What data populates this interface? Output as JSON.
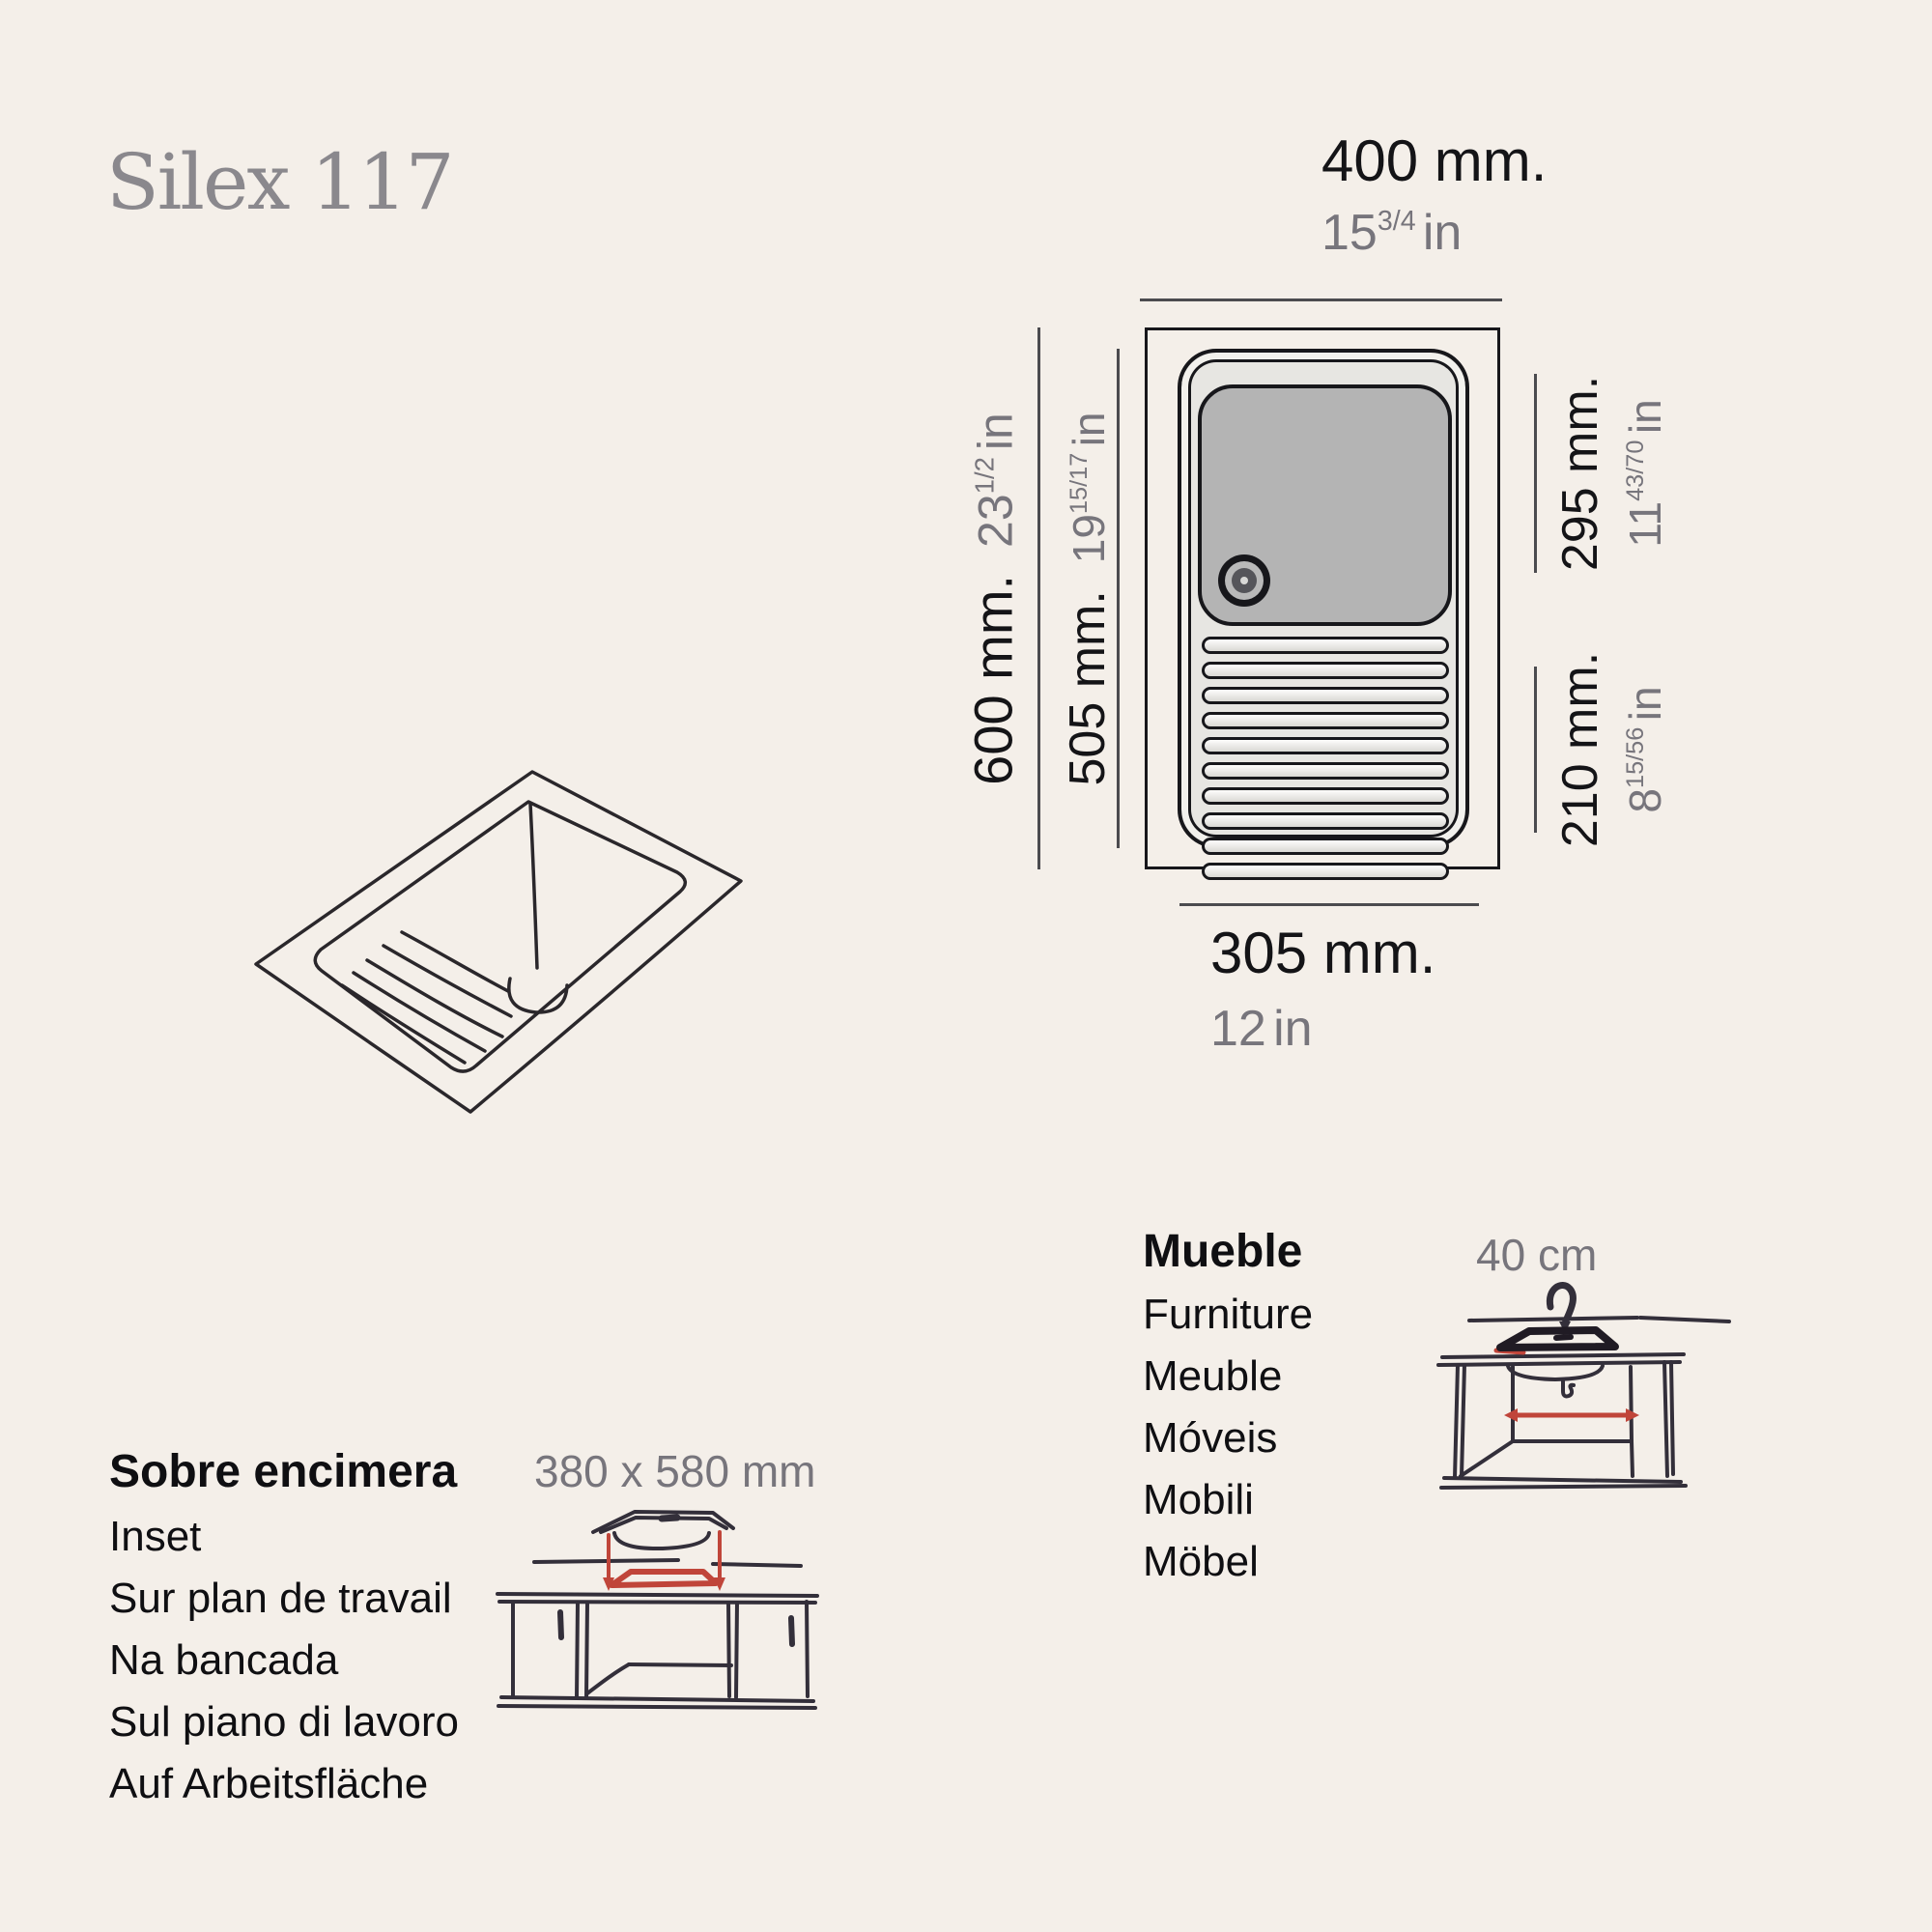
{
  "title": "Silex 117",
  "product_diagram": {
    "dim_top": {
      "mm": "400 mm.",
      "inch_main": "15",
      "inch_frac": "3/4",
      "inch_unit": "in"
    },
    "dim_left_outer": {
      "mm": "600 mm.",
      "inch_main": "23",
      "inch_frac": "1/2",
      "inch_unit": "in"
    },
    "dim_left_inner": {
      "mm": "505 mm.",
      "inch_main": "19",
      "inch_frac": "15/17",
      "inch_unit": "in"
    },
    "dim_right_upper": {
      "mm": "295 mm.",
      "inch_main": "11",
      "inch_frac": "43/70",
      "inch_unit": "in"
    },
    "dim_right_lower": {
      "mm": "210 mm.",
      "inch_main": "8",
      "inch_frac": "15/56",
      "inch_unit": "in"
    },
    "dim_bottom": {
      "mm": "305 mm.",
      "inch_main": "12",
      "inch_frac": "",
      "inch_unit": "in"
    }
  },
  "installation_inset": {
    "heading": "Sobre encimera",
    "translations": [
      "Inset",
      "Sur plan de travail",
      "Na bancada",
      "Sul piano di lavoro",
      "Auf Arbeitsfläche"
    ],
    "cutout_size": "380 x 580 mm"
  },
  "installation_furniture": {
    "heading": "Mueble",
    "translations": [
      "Furniture",
      "Meuble",
      "Móveis",
      "Mobili",
      "Möbel"
    ],
    "cabinet_width": "40 cm"
  },
  "colors": {
    "background": "#f4efe9",
    "ink": "#141417",
    "muted_gray": "#77757c",
    "title_gray": "#8a888d",
    "accent_red": "#c0453a",
    "basin_gray": "#b4b4b4",
    "sketch_ink": "#332f3a"
  }
}
